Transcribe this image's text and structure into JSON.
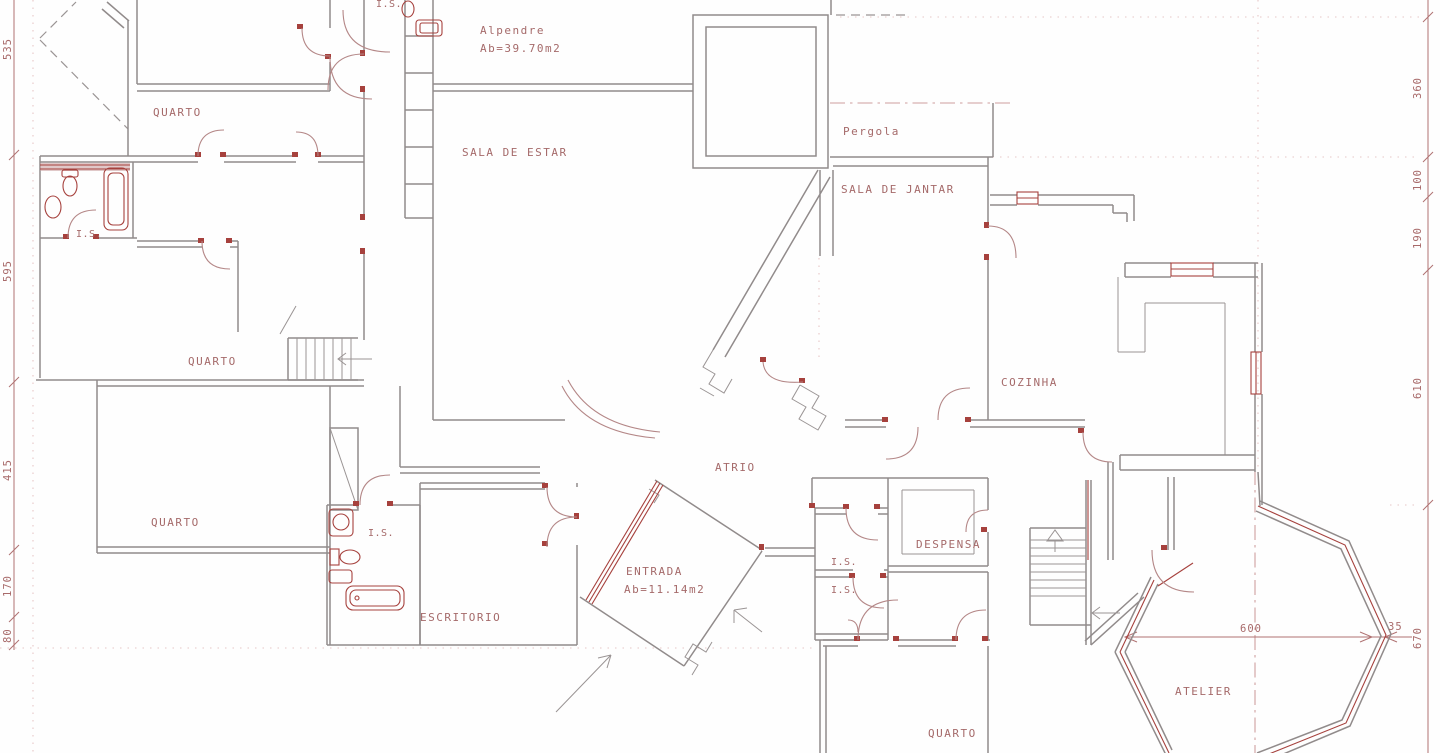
{
  "drawing": {
    "type": "architectural floor plan (ground floor, CAD)",
    "language": "Portuguese",
    "colors": {
      "background": "#fefefe",
      "walls": "#918b8b",
      "accent_red": "#a6413d",
      "door_arcs": "#b48787",
      "text": "#a56a6a",
      "guides": "#e6c6c6"
    }
  },
  "rooms": [
    {
      "id": "quarto-top",
      "label": "QUARTO"
    },
    {
      "id": "is-top-left",
      "label": "I.S."
    },
    {
      "id": "is-top-mid",
      "label": "I.S."
    },
    {
      "id": "alpendre",
      "label": "Alpendre",
      "area": "Ab=39.70m2"
    },
    {
      "id": "sala-de-estar",
      "label": "SALA DE ESTAR"
    },
    {
      "id": "pergola",
      "label": "Pergola"
    },
    {
      "id": "sala-de-jantar",
      "label": "SALA DE JANTAR"
    },
    {
      "id": "quarto-mid",
      "label": "QUARTO"
    },
    {
      "id": "cozinha",
      "label": "COZINHA"
    },
    {
      "id": "atrio",
      "label": "ATRIO"
    },
    {
      "id": "quarto-lower",
      "label": "QUARTO"
    },
    {
      "id": "is-lower",
      "label": "I.S."
    },
    {
      "id": "despensa",
      "label": "DESPENSA"
    },
    {
      "id": "is-hall-1",
      "label": "I.S."
    },
    {
      "id": "is-hall-2",
      "label": "I.S."
    },
    {
      "id": "entrada",
      "label": "ENTRADA",
      "area": "Ab=11.14m2"
    },
    {
      "id": "escritorio",
      "label": "ESCRITORIO"
    },
    {
      "id": "atelier",
      "label": "ATELIER"
    },
    {
      "id": "quarto-bottom",
      "label": "QUARTO"
    }
  ],
  "dimensions": {
    "left_chain": [
      "535",
      "595",
      "415",
      "170",
      "80"
    ],
    "right_chain": [
      "360",
      "100",
      "190",
      "610",
      "670"
    ],
    "atelier_width": "600",
    "atelier_wall_offset": "35"
  }
}
